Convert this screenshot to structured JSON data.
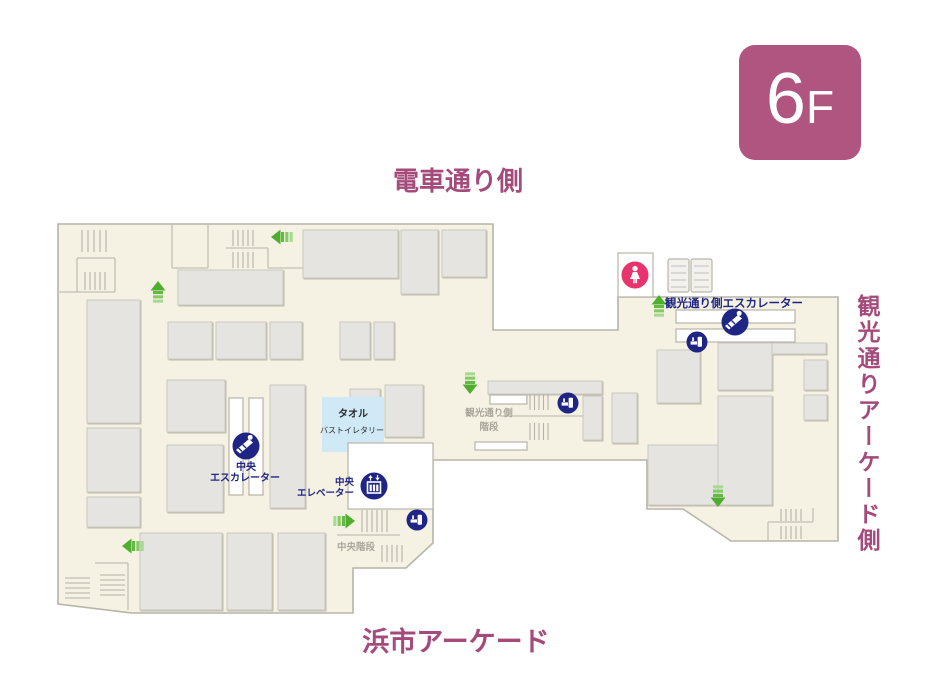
{
  "floor_badge": {
    "number": "6",
    "suffix": "F"
  },
  "edge_labels": {
    "top": "電車通り側",
    "bottom": "浜市アーケード",
    "right": "観光通りアーケード側"
  },
  "facilities": {
    "kanko_escalator": "観光通り側エスカレーター",
    "central_escalator_line1": "中央",
    "central_escalator_line2": "エスカレーター",
    "central_elevator_line1": "中央",
    "central_elevator_line2": "エレベーター",
    "kanko_stairs_line1": "観光通り側",
    "kanko_stairs_line2": "階段",
    "central_stairs": "中央階段"
  },
  "departments": {
    "towel_line1": "タオル",
    "towel_line2": "バストイレタリー"
  },
  "colors": {
    "accent_mauve": "#a54b7b",
    "badge_bg": "#b05580",
    "facility_navy": "#1f2585",
    "toilet_pink": "#e8336d",
    "arrow_green": "#5cb536",
    "floor_beige": "#f5f2e3",
    "block_gray": "#e5e4e1",
    "towel_blue": "#cfe9f7"
  }
}
